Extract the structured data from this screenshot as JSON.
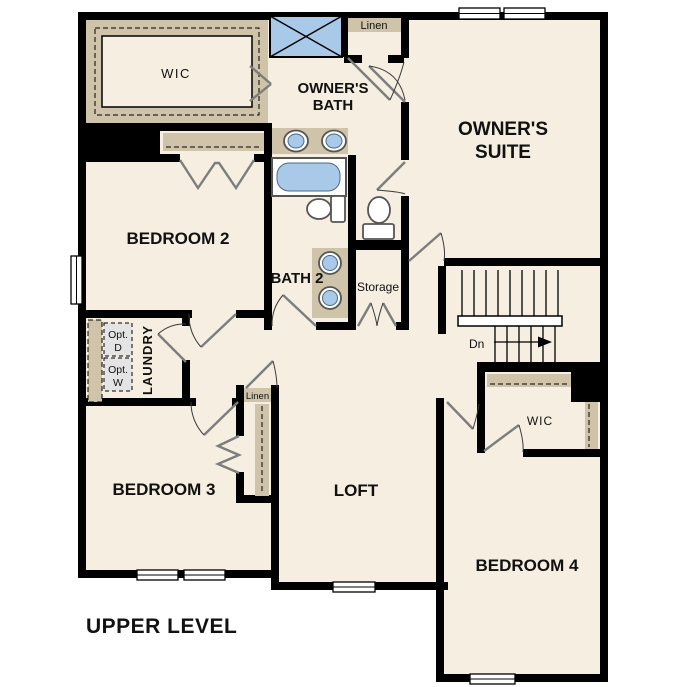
{
  "plan": {
    "title": "UPPER LEVEL",
    "labels": {
      "wic_top": "WIC",
      "owners_bath_1": "OWNER'S",
      "owners_bath_2": "BATH",
      "linen_top": "Linen",
      "owners_suite_1": "OWNER'S",
      "owners_suite_2": "SUITE",
      "bedroom2": "BEDROOM 2",
      "bath2": "BATH 2",
      "storage": "Storage",
      "laundry": "LAUNDRY",
      "opt_d_1": "Opt.",
      "opt_d_2": "D",
      "opt_w_1": "Opt.",
      "opt_w_2": "W",
      "linen_mid": "Linen",
      "bedroom3": "BEDROOM 3",
      "loft": "LOFT",
      "wic_right": "WIC",
      "bedroom4": "BEDROOM 4",
      "down": "Dn"
    },
    "colors": {
      "wall": "#000000",
      "floor": "#f5eee1",
      "shelf_tan": "#cfc3a9",
      "fixture_blue": "#a9c9e8",
      "option_box": "#e4e4e4",
      "background": "#ffffff"
    }
  }
}
